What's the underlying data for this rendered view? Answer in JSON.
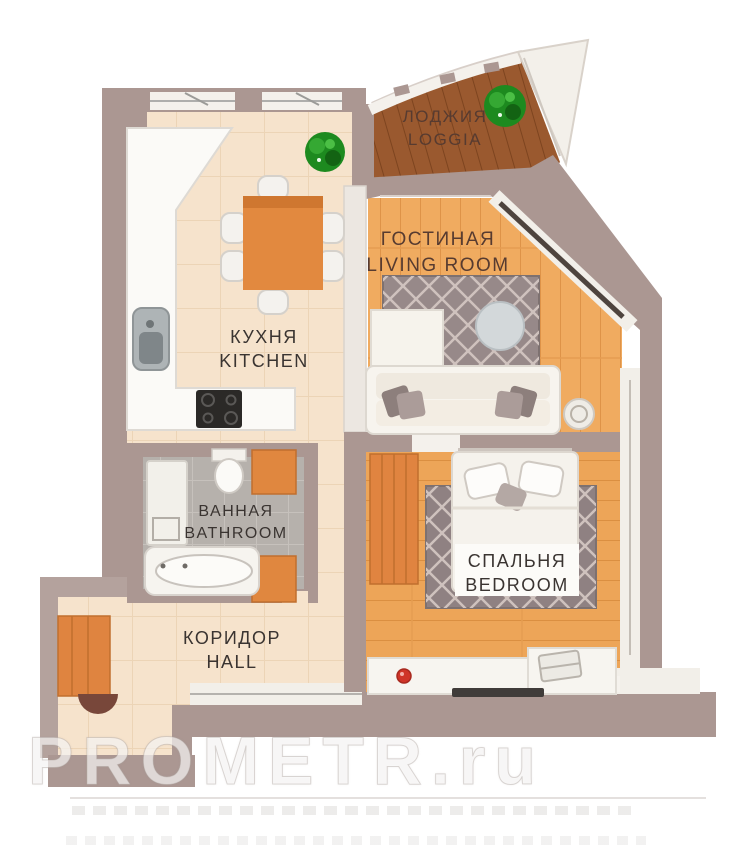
{
  "floorplan": {
    "rooms": {
      "loggia": {
        "ru": "ЛОДЖИЯ",
        "en": "LOGGIA"
      },
      "living": {
        "ru": "ГОСТИНАЯ",
        "en": "LIVING ROOM"
      },
      "kitchen": {
        "ru": "КУХНЯ",
        "en": "KITCHEN"
      },
      "bathroom": {
        "ru": "ВАННАЯ",
        "en": "BATHROOM"
      },
      "bedroom": {
        "ru": "СПАЛЬНЯ",
        "en": "BEDROOM"
      },
      "hall": {
        "ru": "КОРИДОР",
        "en": "HALL"
      }
    },
    "watermark": {
      "text": "PROMETR.ru"
    },
    "colors": {
      "wall": "#ab9792",
      "tile_floor": "#f6e3cc",
      "wood_floor": "#f0ab60",
      "loggia_floor": "#9a592f",
      "bathroom_floor": "#b6b1ac",
      "furniture_orange": "#e0873f",
      "rug": "#978989",
      "plant_green": "#249b26",
      "label_dark": "#3a3431",
      "label_brown": "#573b30",
      "red_accent": "#cf3428"
    }
  }
}
